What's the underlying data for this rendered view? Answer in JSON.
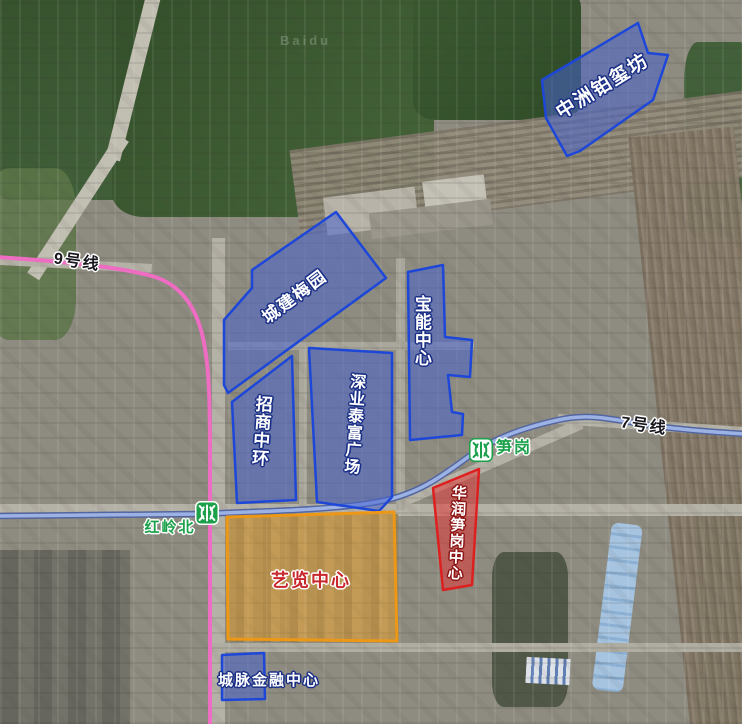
{
  "watermark": "Baidu",
  "colors": {
    "area-blue-stroke": "#1d47d8",
    "area-blue-fill": "rgba(72,101,205,0.55)",
    "area-orange-stroke": "#ec9716",
    "area-orange-fill": "rgba(242,170,58,0.38)",
    "area-red-stroke": "#de1f1f",
    "area-red-fill": "rgba(230,56,56,0.52)",
    "label-blue-outline": "#1a2f85",
    "label-red-text": "#c8272c",
    "station-green": "#1ba14a"
  },
  "lines": {
    "line9": {
      "label": "9号线",
      "color": "#ee6cc2",
      "path": "M -3 257 C 55 261 115 266 152 276 C 180 284 196 306 203 338 C 209 365 210 400 210 455 L 210 724"
    },
    "line7": {
      "label": "7号线",
      "color": "#9db2e4",
      "casing": "#53669f",
      "path": "M -3 516 L 196 514 C 280 511 345 509 382 501 C 420 493 442 476 468 457 C 492 439 522 428 558 420 C 585 414 602 417 648 425 C 690 431 718 432 745 434"
    }
  },
  "stations": [
    {
      "name": "红岭北"
    },
    {
      "name": "笋岗"
    }
  ],
  "areas": [
    {
      "label": "中洲铂玺坊",
      "type": "blue",
      "points": "638,23 648,53 668,55 653,100 580,151 567,156 546,118 542,80"
    },
    {
      "label": "城建梅园",
      "type": "blue",
      "points": "336,212 386,278 228,393 224,385 224,320 252,288 252,270"
    },
    {
      "label": "宝能中心",
      "type": "blue",
      "points": "408,272 443,265 445,337 472,340 470,377 448,375 452,412 463,414 462,435 410,440"
    },
    {
      "label": "深业泰富广场",
      "type": "blue",
      "points": "309,348 392,353 392,497 379,511 317,502"
    },
    {
      "label": "招商中环",
      "type": "blue",
      "points": "232,402 292,356 296,500 237,503"
    },
    {
      "label": "艺览中心",
      "type": "orange",
      "points": "227,517 394,512 397,641 228,639"
    },
    {
      "label": "华润笋岗中心",
      "type": "red",
      "points": "433,488 479,469 472,585 443,590"
    },
    {
      "label": "城脉金融中心",
      "type": "blue",
      "points": "222,655 264,653 265,699 222,700"
    }
  ]
}
